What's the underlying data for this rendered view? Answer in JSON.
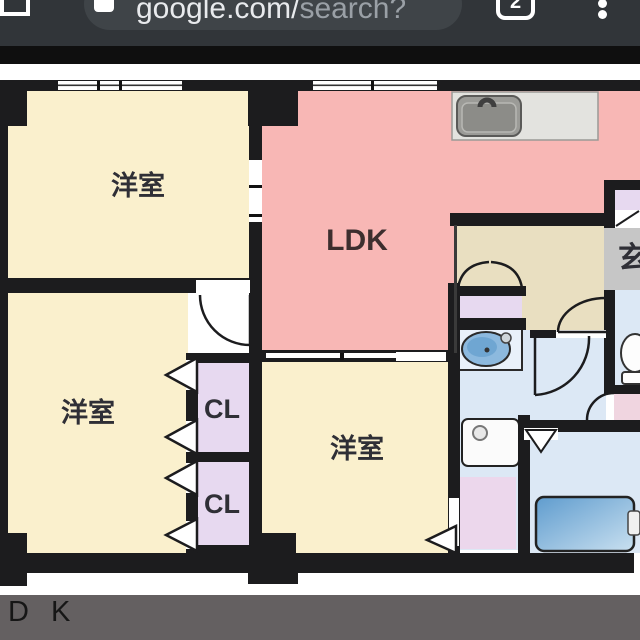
{
  "browser": {
    "address_bar": {
      "host": "google.com/",
      "path": "search?"
    },
    "tab_count": "2"
  },
  "image_viewer": {
    "caption": "D K"
  },
  "floorplan": {
    "labels": {
      "bedroom_top_left": "洋室",
      "bedroom_bottom_left": "洋室",
      "bedroom_center": "洋室",
      "ldk": "LDK",
      "closet_top": "CL",
      "closet_bottom": "CL",
      "entrance": "玄"
    },
    "colors": {
      "wall": "#1c1c1e",
      "room_cream": "#faf0cd",
      "ldk_pink": "#f8b7b5",
      "closet_lavender": "#e7d9f0",
      "hallway_beige": "#e9dfc1",
      "water_blue": "#dce8f5",
      "dressing_pink": "#ecd7ec",
      "entry_mat_pink": "#f0d5e0",
      "genkan_gray": "#c6c6c6",
      "counter_gray": "#e3e3df",
      "sink_gray": "#9b9b97",
      "tub_blue": "#68a4d4",
      "basin_blue": "#8cb9de"
    }
  }
}
